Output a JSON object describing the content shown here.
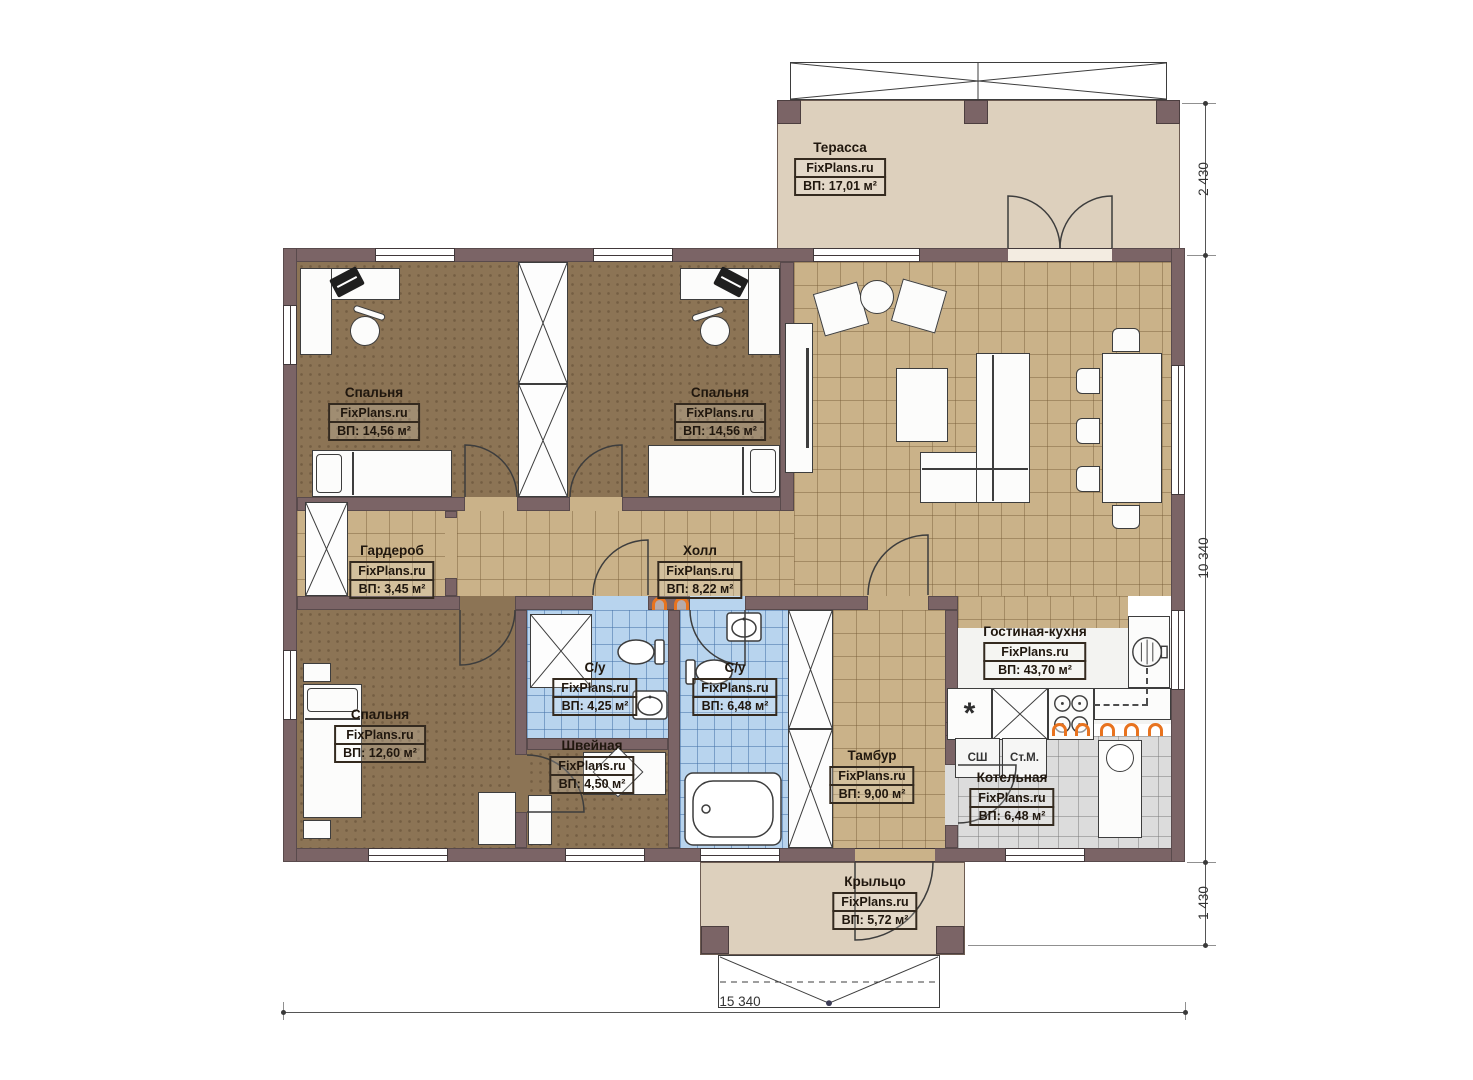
{
  "rooms": [
    {
      "name": "Терасса",
      "brand": "FixPlans.ru",
      "area": "ВП: 17,01 м²"
    },
    {
      "name": "Спальня",
      "brand": "FixPlans.ru",
      "area": "ВП: 14,56 м²"
    },
    {
      "name": "Спальня",
      "brand": "FixPlans.ru",
      "area": "ВП: 14,56 м²"
    },
    {
      "name": "Гардероб",
      "brand": "FixPlans.ru",
      "area": "ВП: 3,45 м²"
    },
    {
      "name": "Холл",
      "brand": "FixPlans.ru",
      "area": "ВП: 8,22 м²"
    },
    {
      "name": "Спальня",
      "brand": "FixPlans.ru",
      "area": "ВП: 12,60 м²"
    },
    {
      "name": "С/у",
      "brand": "FixPlans.ru",
      "area": "ВП: 4,25 м²"
    },
    {
      "name": "С/у",
      "brand": "FixPlans.ru",
      "area": "ВП: 6,48 м²"
    },
    {
      "name": "Швейная",
      "brand": "FixPlans.ru",
      "area": "ВП: 4,50 м²"
    },
    {
      "name": "Тамбур",
      "brand": "FixPlans.ru",
      "area": "ВП: 9,00 м²"
    },
    {
      "name": "Гостиная-кухня",
      "brand": "FixPlans.ru",
      "area": "ВП: 43,70 м²"
    },
    {
      "name": "Котельная",
      "brand": "FixPlans.ru",
      "area": "ВП: 6,48 м²"
    },
    {
      "name": "Крыльцо",
      "brand": "FixPlans.ru",
      "area": "ВП: 5,72 м²"
    }
  ],
  "appliances": {
    "dryer": "СШ",
    "washer": "Ст.М.",
    "fridge_symbol": "*"
  },
  "dimensions": {
    "terrace_depth": "2 430",
    "house_depth": "10 340",
    "porch_depth": "1 430",
    "total_width": "15 340"
  },
  "colors": {
    "wall": "#7b6466",
    "tile_tan": "#cab289",
    "tile_blue": "#b8d4ee",
    "tile_gray": "#dcdcdc",
    "carpet": "#8c7455",
    "deck": "#ddd0bd",
    "radiator": "#e8731f"
  }
}
